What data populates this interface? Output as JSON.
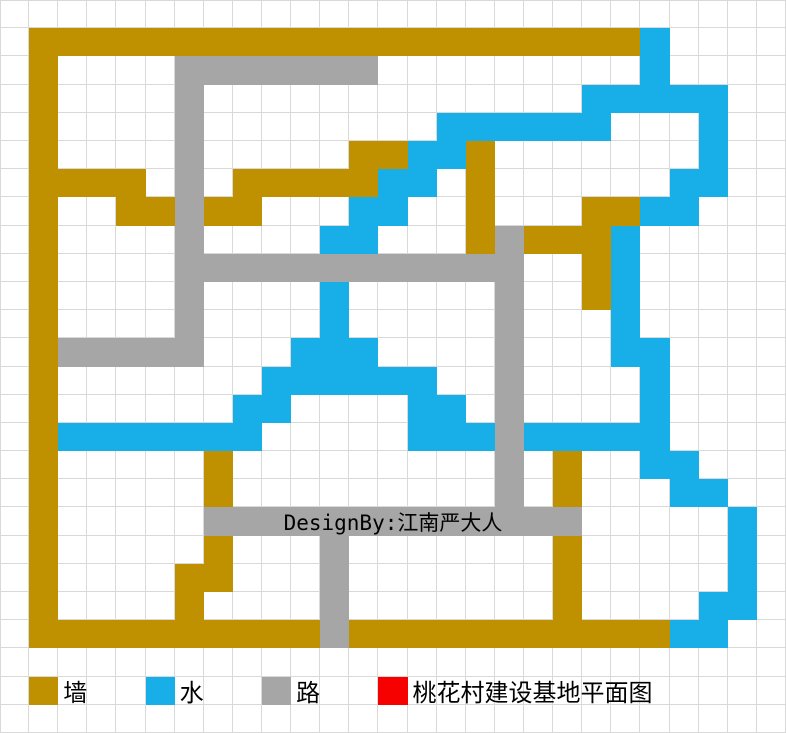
{
  "app": {
    "description": "spreadsheet pixel-art construction plan",
    "title_label": "桃花村建设基地平面图"
  },
  "palette": {
    "wall": "#BF9000",
    "water": "#18AEE8",
    "road": "#A6A6A6",
    "marker": "#F70000",
    "grid_line": "#D9D9D9",
    "background": "#FFFFFF",
    "text": "#000000"
  },
  "grid": {
    "cols": 27,
    "rows": 26,
    "cell_codes": {
      ".": "empty",
      "G": "wall",
      "B": "water",
      "R": "road",
      "D": "marker"
    },
    "rows_map": [
      "...........................",
      ".GGGGGGGGGGGGGGGGGGGGGB....",
      ".G....RRRRRRR.........B....",
      ".G....R.............BBBBB..",
      ".G....R........BBBBBB...B..",
      ".G....R.....GGBBG.......B..",
      ".GGGG.R.GGGGGBB.G......BB..",
      ".G..GGRGG...BB..G...GGBB...",
      ".G....R....BB...GRGGGB.....",
      ".G....RRRRRRRRRRRR..GB.....",
      ".G....R....B.....R..GB.....",
      ".G....R....B.....R...B.....",
      ".GRRRRR...BBB....R...BB....",
      ".G.......BBBBBB..R....B....",
      ".G......BB....BB.R....B....",
      ".GBBBBBBB.....BBBRBBBBB....",
      ".G.....G.........R.G..BB...",
      ".G.....G.........R.G...BB..",
      ".G.....RRRRRRRRRRRRR.....B.",
      ".G.....G...R.......G.....B.",
      ".G....GG...R.......G.....B.",
      ".G....G....R.......G....BB.",
      ".GGGGGGGGGGRGGGGGGGGGGGBB..",
      "...........................",
      ".G...B...R...D.............",
      "..........................."
    ]
  },
  "designer_credit": {
    "text": "DesignBy:江南严大人",
    "row": 18,
    "col_start": 7,
    "col_end": 19
  },
  "legend": {
    "row": 24,
    "items": [
      {
        "key": "wall",
        "label": "墙",
        "color": "#BF9000",
        "col": 1
      },
      {
        "key": "water",
        "label": "水",
        "color": "#18AEE8",
        "col": 5
      },
      {
        "key": "road",
        "label": "路",
        "color": "#A6A6A6",
        "col": 9
      },
      {
        "key": "title",
        "label": "桃花村建设基地平面图",
        "color": "#F70000",
        "col": 13
      }
    ]
  }
}
